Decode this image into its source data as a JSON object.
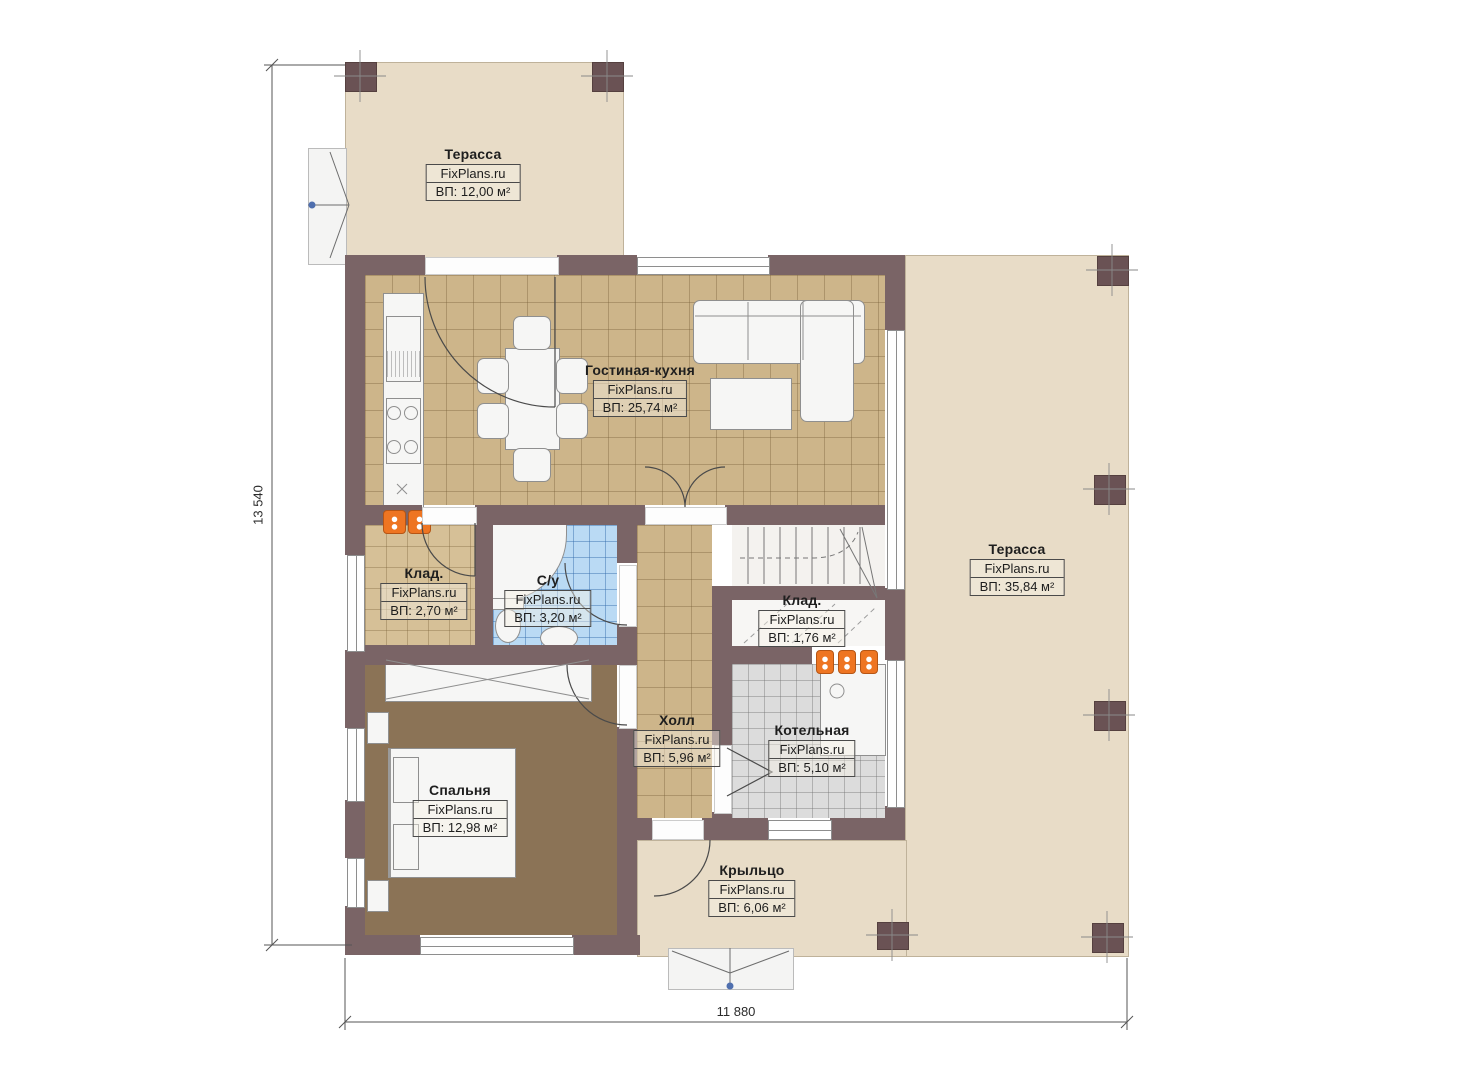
{
  "brand": "FixPlans.ru",
  "rooms": {
    "terrace_top": {
      "name": "Терасса",
      "area": "ВП: 12,00 м²"
    },
    "living_kitchen": {
      "name": "Гостиная-кухня",
      "area": "ВП: 25,74 м²"
    },
    "terrace_right": {
      "name": "Терасса",
      "area": "ВП: 35,84 м²"
    },
    "storage_left": {
      "name": "Клад.",
      "area": "ВП: 2,70 м²"
    },
    "bathroom": {
      "name": "С/у",
      "area": "ВП: 3,20 м²"
    },
    "storage_right": {
      "name": "Клад.",
      "area": "ВП: 1,76 м²"
    },
    "hall": {
      "name": "Холл",
      "area": "ВП: 5,96 м²"
    },
    "boiler": {
      "name": "Котельная",
      "area": "ВП: 5,10 м²"
    },
    "bedroom": {
      "name": "Спальня",
      "area": "ВП: 12,98 м²"
    },
    "porch": {
      "name": "Крыльцо",
      "area": "ВП: 6,06 м²"
    }
  },
  "dimensions": {
    "vertical": "13 540",
    "horizontal": "11 880"
  },
  "colors": {
    "wall": "#7a6466",
    "terrace": "#e8dcc7",
    "tile_tan": "#cdb58a",
    "wood_floor": "#8b7356",
    "tile_blue": "#badaf4",
    "tile_gray": "#dcdcdc",
    "radiator": "#ee7522",
    "marker_blue": "#4f6fae"
  }
}
